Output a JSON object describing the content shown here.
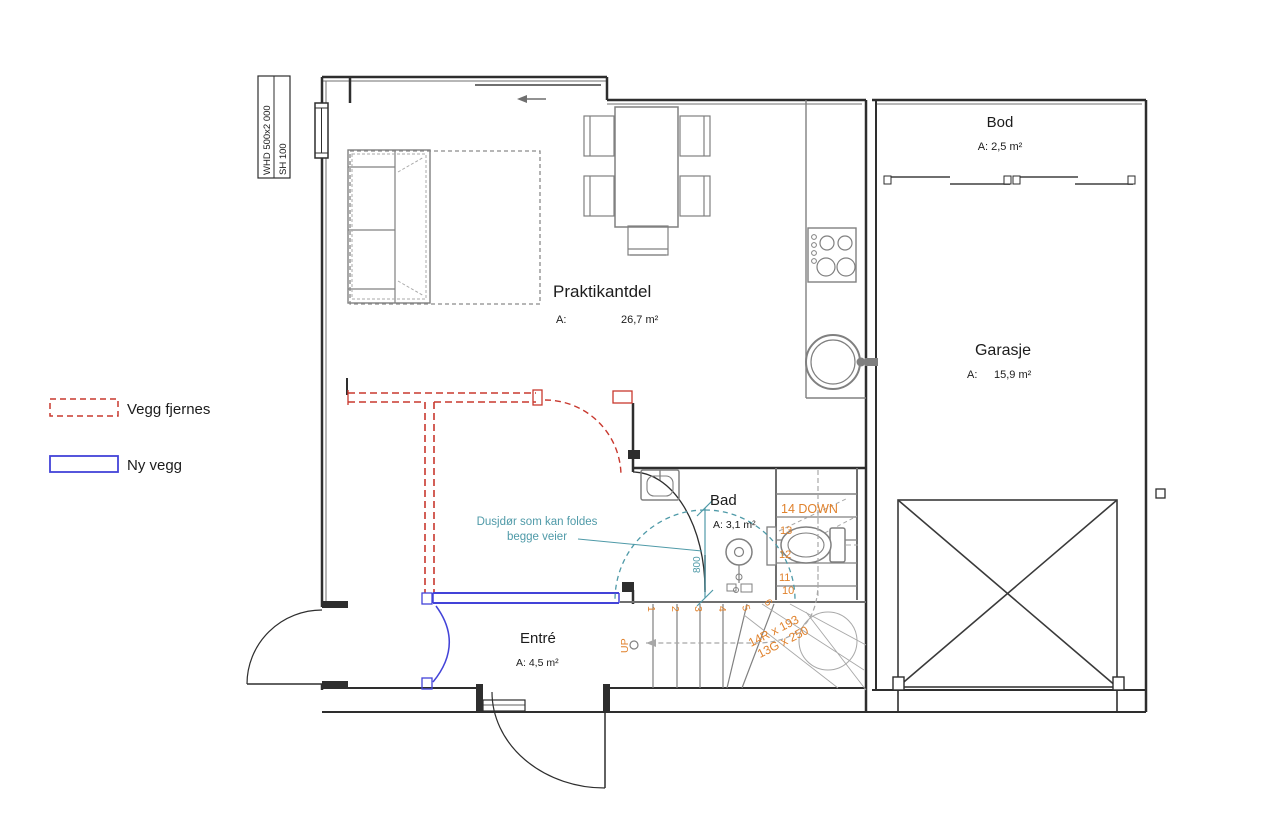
{
  "plan": {
    "title_block": {
      "row1": "WHD 500x2 000",
      "row2": "SH 100"
    },
    "legend": {
      "removed_wall_label": "Vegg fjernes",
      "new_wall_label": "Ny vegg"
    },
    "rooms": {
      "praktikantdel": {
        "name": "Praktikantdel",
        "area_label": "A:",
        "area_value": "26,7 m²"
      },
      "bod": {
        "name": "Bod",
        "area": "A: 2,5 m²"
      },
      "garasje": {
        "name": "Garasje",
        "area_label": "A:",
        "area_value": "15,9 m²"
      },
      "bad": {
        "name": "Bad",
        "area": "A: 3,1 m²"
      },
      "entre": {
        "name": "Entré",
        "area": "A: 4,5 m²"
      }
    },
    "annotations": {
      "shower_note_line1": "Dusjdør som kan foldes",
      "shower_note_line2": "begge veier",
      "shower_width_dim": "800",
      "stair_down_label": "14 DOWN",
      "stair_up_label": "UP",
      "riser_numbers": [
        "13",
        "12",
        "11",
        "10"
      ],
      "tread_numbers": [
        "1",
        "2",
        "3",
        "4",
        "5",
        "6"
      ],
      "stair_spec_risers": "14R x 193",
      "stair_spec_goings": "13G x 250"
    },
    "colors": {
      "removed_wall": "#c8382e",
      "new_wall": "#4343d8",
      "note_teal": "#4f9aa8",
      "stair_orange": "#e0822d",
      "wall": "#2e2e2e"
    }
  }
}
